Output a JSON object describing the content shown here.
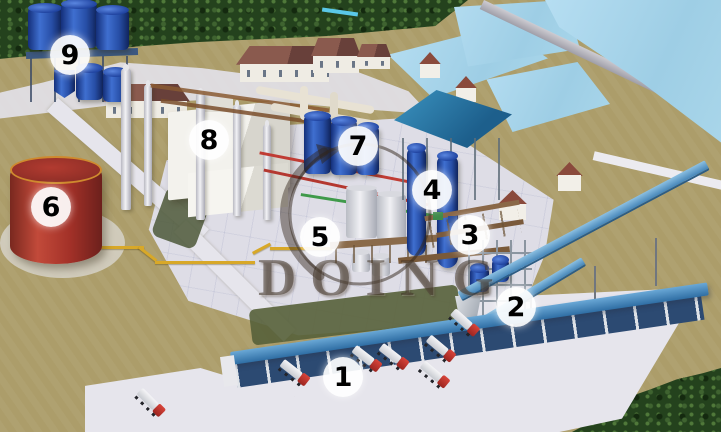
{
  "watermark": {
    "text": "DOING"
  },
  "markers": [
    {
      "label": "1"
    },
    {
      "label": "2"
    },
    {
      "label": "3"
    },
    {
      "label": "4"
    },
    {
      "label": "5"
    },
    {
      "label": "6"
    },
    {
      "label": "7"
    },
    {
      "label": "8"
    },
    {
      "label": "9"
    }
  ],
  "palette": {
    "ground_tan": "#ac9d6a",
    "pond_blue": "#a6d5eb",
    "tree_green": "#24421d",
    "concrete_light": "#e2e1e8",
    "storage_tank_red": "#a93832",
    "process_tank_blue": "#2a52b8",
    "house_roof_red": "#7c4f45",
    "station_roof_blue": "#2d7fa8",
    "conveyor_blue": "#4a90c4",
    "truck_cab_red": "#b82820",
    "pipeline_yellow": "#d8a828",
    "marker_background": "#ffffff",
    "marker_number": "#000000"
  }
}
